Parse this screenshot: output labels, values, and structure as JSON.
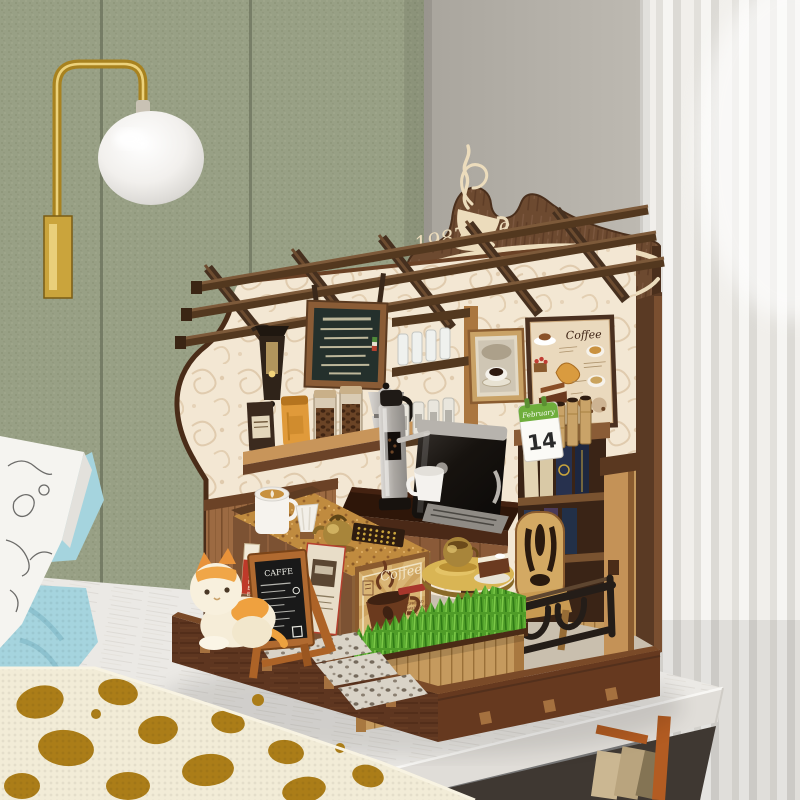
{
  "model": {
    "sign": {
      "title": "1987cafe"
    },
    "dessert_board": {
      "title": "Coffee"
    },
    "calendar": {
      "month": "February",
      "day": "14"
    },
    "chalkboard": {
      "title": "CAFFE"
    },
    "poster": {
      "title": "Coffee",
      "line1": "ESPRESSO",
      "line2": "AMERICANO",
      "line3": "LATTE"
    },
    "banner": {
      "text": "COFFEE"
    }
  },
  "palette": {
    "wall_green": "#99a086",
    "wall_gray": "#b2aea6",
    "curtain": "#efedec",
    "tabletop": "#ebe9e5",
    "wood_dark": "#5a3723",
    "wood_mid": "#8a5c36",
    "wood_light": "#c69a5e",
    "wallpaper": "#f3e7d3",
    "grass": "#4f9c28",
    "blanket_blue": "#a5d4de",
    "leopard_gold": "#ab7d18",
    "brass": "#b8912f",
    "chalk_frame": "#ad6327",
    "calendar_green": "#6fae3c",
    "poster_red": "#a8372c",
    "machine_black": "#15120f"
  }
}
